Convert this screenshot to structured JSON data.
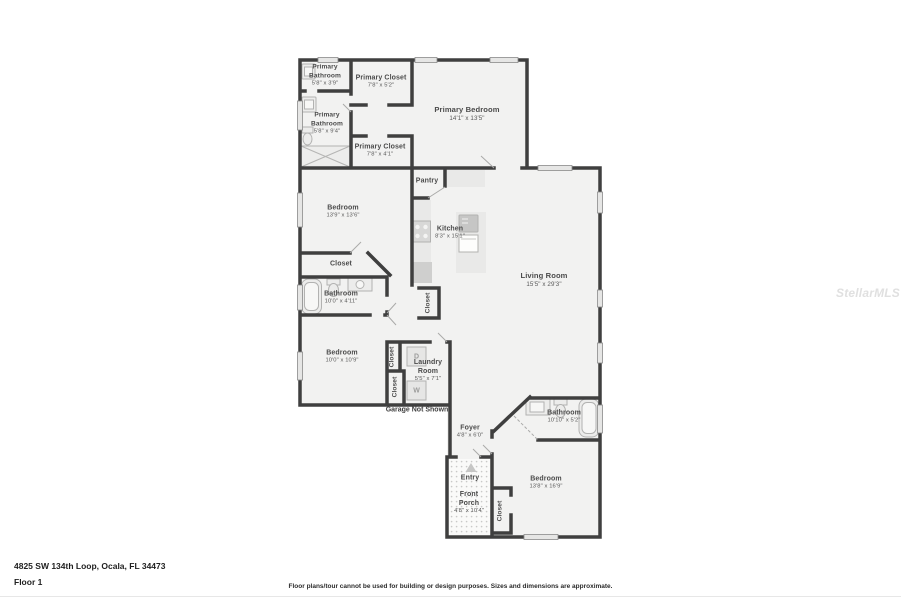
{
  "page": {
    "address": "4825 SW 134th Loop, Ocala, FL 34473",
    "floor": "Floor 1",
    "disclaimer": "Floor plans/tour cannot be used for building or design purposes. Sizes and dimensions are approximate.",
    "watermark": "StellarMLS",
    "garage_note": "Garage Not Shown"
  },
  "colors": {
    "wall": "#3f3f3f",
    "floor": "#f2f2f1",
    "fixture": "#ececeb",
    "label": "#4b4b4b",
    "watermark": "#e0e0e0"
  },
  "rooms": {
    "primary_bathroom_small": {
      "name_line1": "Primary",
      "name_line2": "Bathroom",
      "dims": "5'8\" x 3'9\""
    },
    "primary_closet_top": {
      "name": "Primary Closet",
      "dims": "7'8\" x 5'2\""
    },
    "primary_bedroom": {
      "name": "Primary Bedroom",
      "dims": "14'1\" x 13'5\""
    },
    "primary_bathroom_large": {
      "name_line1": "Primary",
      "name_line2": "Bathroom",
      "dims": "5'8\" x 9'4\""
    },
    "primary_closet_bottom": {
      "name": "Primary Closet",
      "dims": "7'8\" x 4'1\""
    },
    "bedroom_mid": {
      "name": "Bedroom",
      "dims": "13'9\" x 13'6\""
    },
    "pantry": {
      "name": "Pantry"
    },
    "kitchen": {
      "name": "Kitchen",
      "dims": "8'3\" x 15'1\""
    },
    "living_room": {
      "name": "Living Room",
      "dims": "15'5\" x 29'3\""
    },
    "closet_hall": {
      "name": "Closet"
    },
    "bathroom_mid": {
      "name": "Bathroom",
      "dims": "10'0\" x 4'11\""
    },
    "closet_kitchen": {
      "name": "Closet"
    },
    "bedroom_lower": {
      "name": "Bedroom",
      "dims": "10'0\" x 10'9\""
    },
    "closet_a": {
      "name": "Closet"
    },
    "closet_b": {
      "name": "Closet"
    },
    "laundry": {
      "name_line1": "Laundry",
      "name_line2": "Room",
      "dims": "5'5\" x 7'1\""
    },
    "foyer": {
      "name": "Foyer",
      "dims": "4'8\" x 6'0\""
    },
    "bathroom_right": {
      "name": "Bathroom",
      "dims": "10'10\" x 5'2\""
    },
    "entry": {
      "name": "Entry"
    },
    "front_porch": {
      "name_line1": "Front",
      "name_line2": "Porch",
      "dims": "4'8\" x 10'4\""
    },
    "closet_porch": {
      "name": "Closet"
    },
    "bedroom_right": {
      "name": "Bedroom",
      "dims": "13'8\" x 16'9\""
    },
    "appliances": {
      "dryer": "D",
      "washer": "W"
    }
  }
}
